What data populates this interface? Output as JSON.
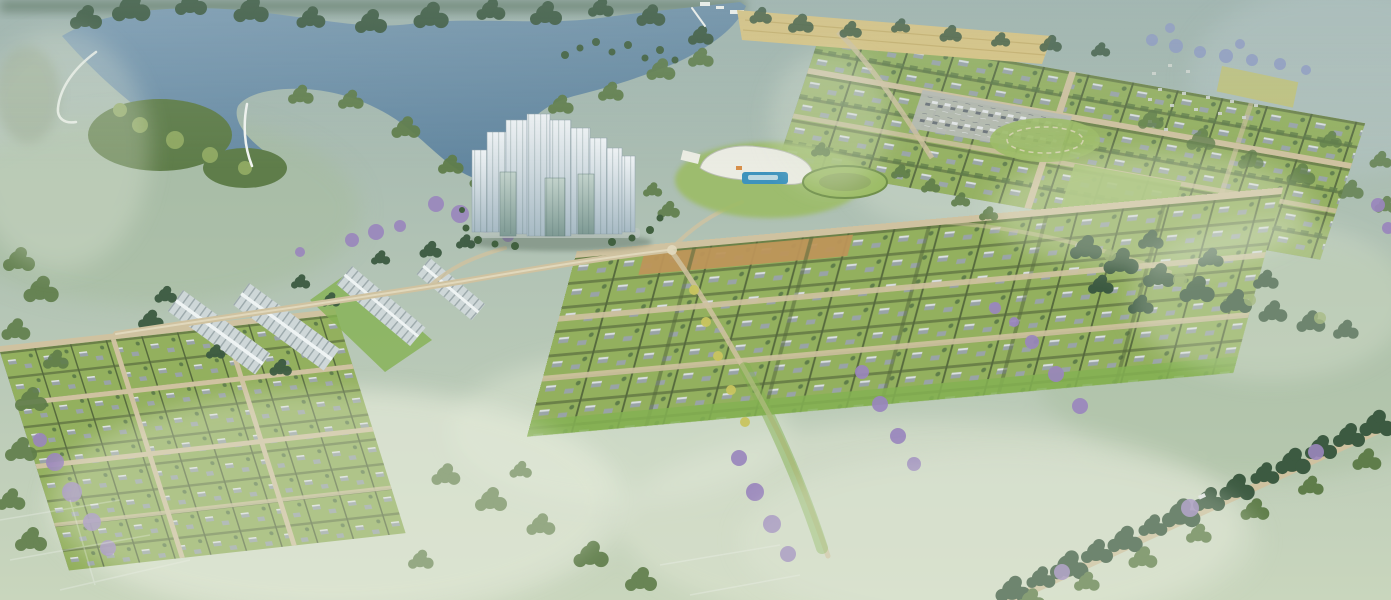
{
  "scene": {
    "description": "Aerial 3D rendering of a township master plan: a lake with wooded shoreline and white bund road at top left, a cluster of slender glass high-rise towers at center, a white clubhouse with swimming pool and oval lawn, four long gable-roofed row-house blocks at left, plotted villa grids with hedge rows, small grey unit roofs and tan internal roads, a sand-colored field, parking lot with cars and amenity lawn at top right, a hazy distant settlement in the far top right, purple flowering trees scattered across the site, a tree-lined diagonal avenue at bottom right, and misty open green fields all around.",
    "towers_count": 12,
    "row_house_blocks": 4,
    "regions": {
      "lake": "lake with wooded shoreline, peninsula and white bund road",
      "towers": "cluster of glass high-rise towers",
      "clubhouse": "clubhouse with swimming pool and oval lawn",
      "row_houses": "long gable-roof row-house blocks",
      "grid_top_right": "plotted layout with parking lot, sand field and amenity lawn",
      "grid_center_right": "large plotted layout with hedge rows and tilled strip",
      "grid_bottom_left": "plotted villa layout with tan cross roads",
      "tree_avenue": "tree-lined diagonal avenue",
      "fields": "hazy open green fields with scattered tree clusters",
      "settlement": "distant hazy settlement"
    }
  },
  "colors": {
    "bg_top": "#9fb4ae",
    "bg_bottom": "#c9d6bd",
    "mist": "#e4ead9",
    "haze_green": "#a6bb9b",
    "haze_blue": "#b6c6c6",
    "lake": "#7d9db4",
    "lake_deep": "#5e839c",
    "marsh": "#93a68f",
    "tree_dark": "#3c5a41",
    "tree_mid": "#5f7d4a",
    "tree_light": "#8fa862",
    "tree_purple": "#9a86bd",
    "purple_blue": "#8d9ac4",
    "palm": "#41603f",
    "flower_yellow": "#c9c45f",
    "plot_green": "#93b05e",
    "hedge": "#6b8148",
    "plot_line": "#566a3d",
    "lawn": "#9cbc66",
    "lawn_bright": "#84b152",
    "road": "#cfc2a0",
    "road_light": "#e2dabf",
    "house_roof": "#99a3a7",
    "house_light": "#dde2e3",
    "rowhouse_roof": "#ced7d8",
    "rowhouse_rib": "#8f9da0",
    "ridge": "#eef3f3",
    "tower_top": "#eff3f5",
    "tower_bottom": "#a7bac4",
    "tower_glass": "#7e9a94",
    "tower_glass_light": "#c2d2cb",
    "tower_stripe": "#5c7775",
    "pool": "#3e93bd",
    "club_white": "#ebece3",
    "sand": "#d9c583",
    "sand_line": "#c4ad67",
    "tilled": "#bd9558",
    "parking": "#b7bcb4",
    "car_white": "#e4e7e8",
    "car_dark": "#6d757b",
    "settlement": "#d2d7d1",
    "field_patch": "#c6c46d",
    "shadow": "#44584a",
    "white": "#f2f5f1"
  }
}
